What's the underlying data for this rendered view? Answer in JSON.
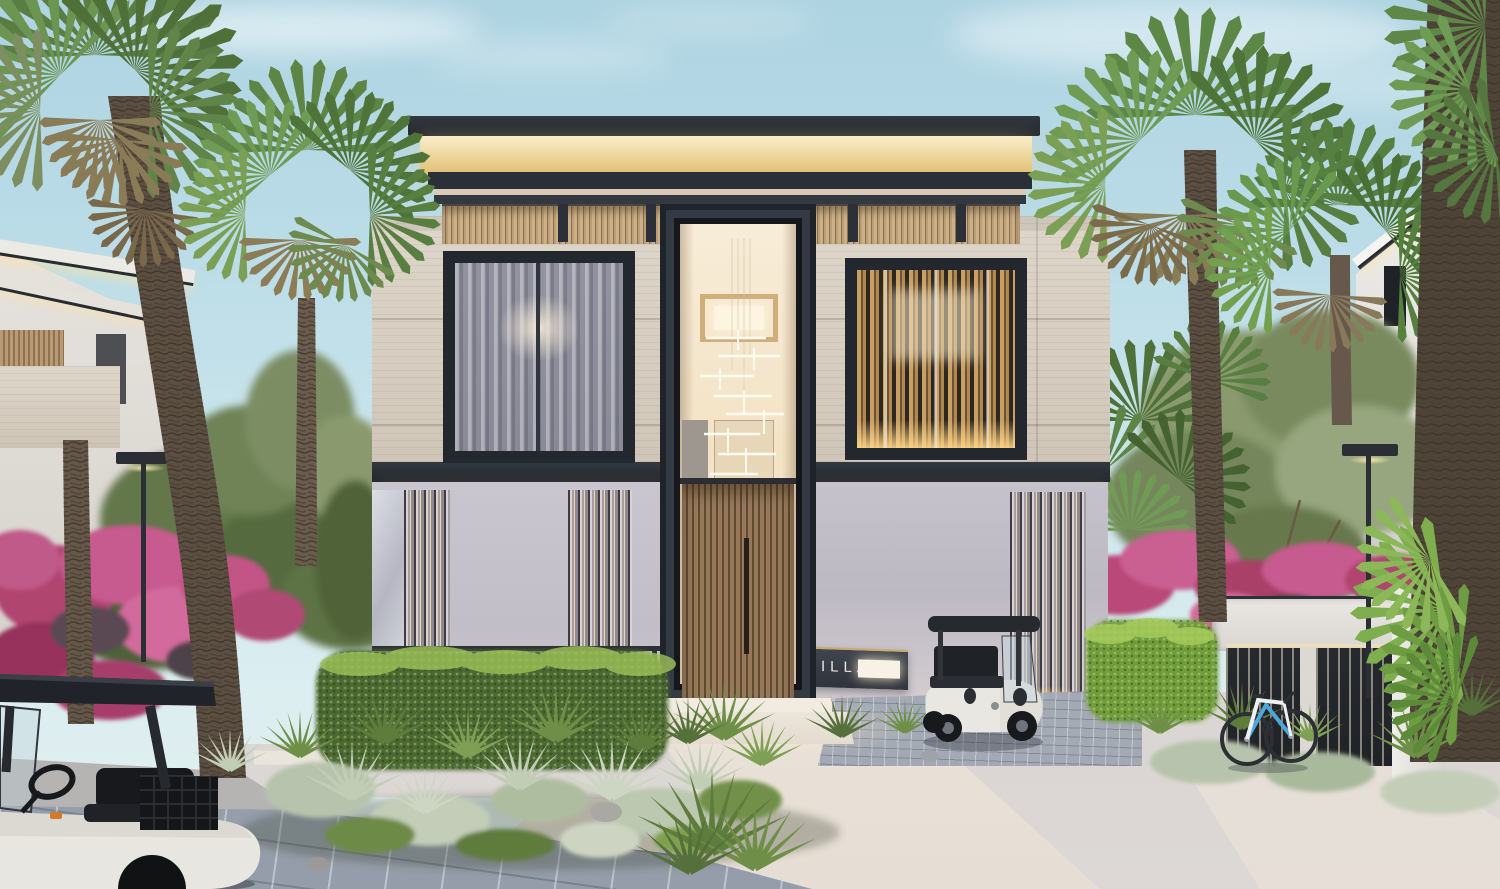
{
  "meta": {
    "title": "Modern villa exterior — dusk architectural rendering"
  },
  "scene": {
    "setting": "residential street at dusk",
    "main_subject": "two-storey contemporary villa with illuminated double-height entrance",
    "foreground": "landscaped beds, paver apron, white walkway, stone driveway"
  },
  "villa": {
    "sign": {
      "label": "VILLA"
    },
    "floors": 2,
    "features": [
      "roof light cove",
      "timber louver parapet band",
      "stone upper facade",
      "sheer-curtain window",
      "bronze louvered window",
      "double-height glazed entrance",
      "timber slat front door",
      "glass fin wall panels",
      "entry steps"
    ]
  },
  "surroundings": {
    "left": [
      "fan palms",
      "foreground golf cart",
      "bougainvillea",
      "street lamp",
      "neighbor villa"
    ],
    "right": [
      "fan palms",
      "parked golf cart",
      "bicycle",
      "slatted garage fence",
      "bougainvillea",
      "street lamp",
      "neighbor villa"
    ]
  },
  "objects": {
    "golf_carts": 2,
    "bicycles": 1,
    "street_lamps": 2,
    "palm_trees": 5
  },
  "colors": {
    "sky_top": "#aed3e1",
    "sky_horizon": "#e3f0f0",
    "roof_dark": "#262b33",
    "roof_glow": "#f2dca4",
    "louver_wood": "#c5a87e",
    "stone_facade": "#d8d0c4",
    "ground_wall": "#c7c3cd",
    "door_wood": "#8a7150",
    "entry_glow": "#f5e7cf",
    "sign_plate": "#363b44",
    "sign_text": "#eae8dc",
    "hedge_green": "#4c6830",
    "hedge_bright": "#9dc258",
    "grass_silver": "#b7c3ac",
    "bougainvillea_pink": "#c44f80",
    "palm_green": "#5f8148",
    "palm_trunk": "#5c4f42",
    "pavement_warm": "#ece5da",
    "paver_blue": "#9ba3af",
    "driveway_gray": "#cfcccd",
    "cart_body": "#e9e7e2",
    "cart_canopy": "#23262b",
    "bicycle_blue": "#4ba7dc",
    "lamp_metal": "#2b2f35"
  }
}
